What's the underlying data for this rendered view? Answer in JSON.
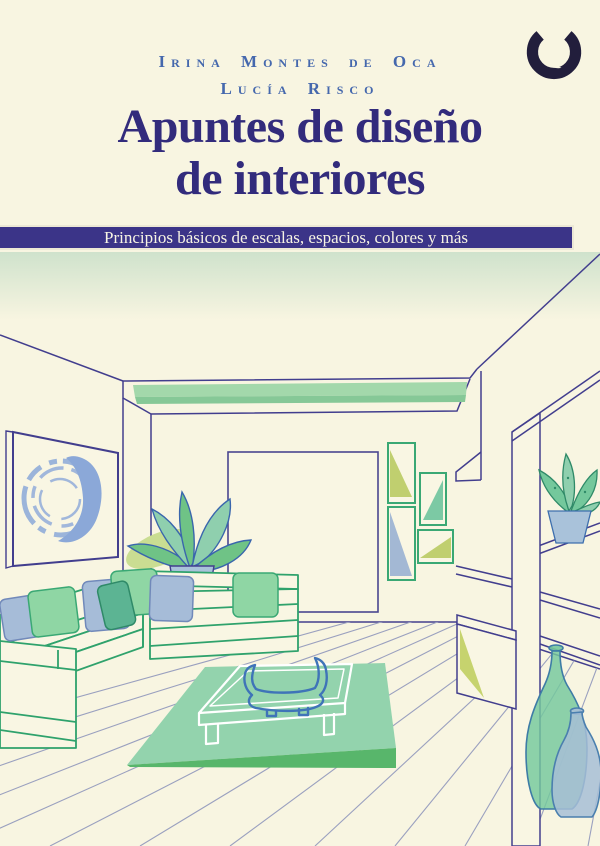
{
  "cover": {
    "authors": {
      "line1": "Irina Montes de Oca",
      "line2": "Lucía Risco"
    },
    "title": {
      "line1": "Apuntes de diseño",
      "line2": "de interiores"
    },
    "banner": {
      "text": "Principios básicos de escalas, espacios, colores y más"
    },
    "logo": {
      "name": "upc-publisher-logo"
    },
    "palette": {
      "background_cream": "#f8f5e1",
      "title_indigo": "#322b7c",
      "banner_indigo": "#3b3488",
      "banner_border": "#ece8d5",
      "author_blue": "#4568ad",
      "logo_dark": "#221e3c",
      "line_indigo": "#423e8e",
      "sofa_green": "#2fa26c",
      "pillow_green": "#8fd6a4",
      "pillow_bluegray": "#a6bcd8",
      "pillow_teal": "#5cb493",
      "rug_green": "#93d3ad",
      "rug_edge_green": "#58b66b",
      "beam_green": "#a3d8ab",
      "painting_blue": "#8ba8d8",
      "accent_yellow_green": "#c6d36e",
      "leaf_green": "#6fc386",
      "pot_blue": "#a9c2da",
      "vase_green": "#74c89c",
      "vase_blue": "#a7bed6",
      "table_white": "#ffffff",
      "bowl_blue": "#3f74b8",
      "plank_gray": "#9aa0bf",
      "ceiling_tint": "#cfe2cc"
    }
  }
}
